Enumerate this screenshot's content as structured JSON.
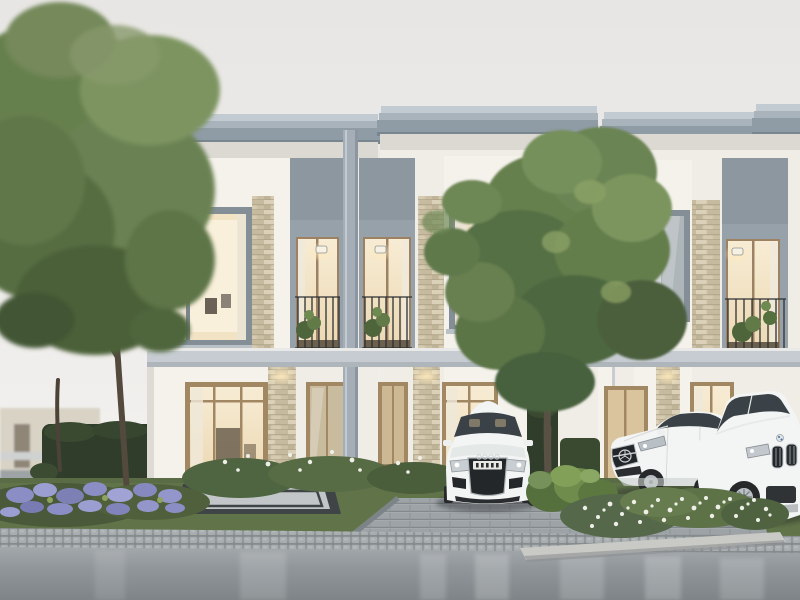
{
  "meta": {
    "title": "Modern white two-storey townhouses with parked cars at dusk",
    "kind": "architectural 3D rendering",
    "time_of_day": "overcast dusk"
  },
  "palette": {
    "sky_top": "#e9e7e5",
    "sky_bottom": "#f6f4f1",
    "wall_white": "#f0ede7",
    "wall_bright": "#f5f2ec",
    "wall_shade": "#dedbd5",
    "roof_gray": "#8f9ba5",
    "cornice_light": "#c3cbd2",
    "cornice_mid": "#a9b3bc",
    "roof_shadow": "#79858f",
    "recess_gray": "#97a1aa",
    "slab_band": "#c6ccd1",
    "pillar_gray": "#a5aeb7",
    "frame_gray": "#848e97",
    "frame_tan": "#a28763",
    "window_warm": "#f2e3c4",
    "window_bright": "#f9f0db",
    "window_cool": "#aeb6ba",
    "stone_beige": "#cfc4aa",
    "sconce_glow": "#ffe9b8",
    "tree_light": "#7d9460",
    "tree_mid": "#66804e",
    "tree_dark": "#4b5f3c",
    "trunk_brown": "#53493d",
    "hedge_dark": "#2f3d2a",
    "bush_green": "#6f8c4c",
    "lawn_green": "#617449",
    "flower_purple": "#8b8ec5",
    "flower_white": "#eef0e8",
    "patio_border": "#3f4447",
    "patio_field": "#c2c6c8",
    "paver_gray": "#9da3a6",
    "curb_gray": "#a6aaac",
    "road_gray": "#8f9598",
    "planter_curb": "#c9cac5",
    "car_white": "#f3f5f4",
    "car_glass": "#3b4247",
    "grille_dark": "#24272a",
    "chrome_silver": "#c6cbd0",
    "tire_black": "#26282a"
  },
  "scene": {
    "buildings": [
      {
        "name": "left-townhouse",
        "floors": 2,
        "features": [
          "boxed bay window",
          "stacked-stone pier",
          "recessed balcony with sconce",
          "glass entry doors",
          "entry patio"
        ]
      },
      {
        "name": "center-townhouse",
        "floors": 2,
        "features": [
          "recessed balcony with sconce",
          "stacked-stone pier",
          "boxed bay window with pendant lights",
          "glass entry doors"
        ]
      },
      {
        "name": "right-townhouse",
        "floors": 2,
        "features": [
          "boxed bay window",
          "stacked-stone pier",
          "recessed balcony with sconce",
          "glass entry doors"
        ]
      }
    ],
    "vehicles": [
      {
        "name": "white-coupe",
        "view": "front",
        "location": "left driveway bay"
      },
      {
        "name": "white-sedan",
        "view": "three-quarter front",
        "location": "center driveway bay"
      },
      {
        "name": "white-suv",
        "view": "three-quarter front",
        "location": "right driveway bay"
      }
    ],
    "vegetation": [
      "large tree left",
      "large tree center",
      "clipped hedge",
      "purple flower bed",
      "white wildflower planter",
      "leafy shrub",
      "balcony plants"
    ],
    "ground": [
      "entry patio",
      "paver driveway",
      "grass-grid parking edge",
      "lawn",
      "sett curb strip",
      "asphalt road"
    ],
    "lighting": [
      "warm interior glow",
      "balcony wall sconces",
      "soffit downlights"
    ]
  }
}
